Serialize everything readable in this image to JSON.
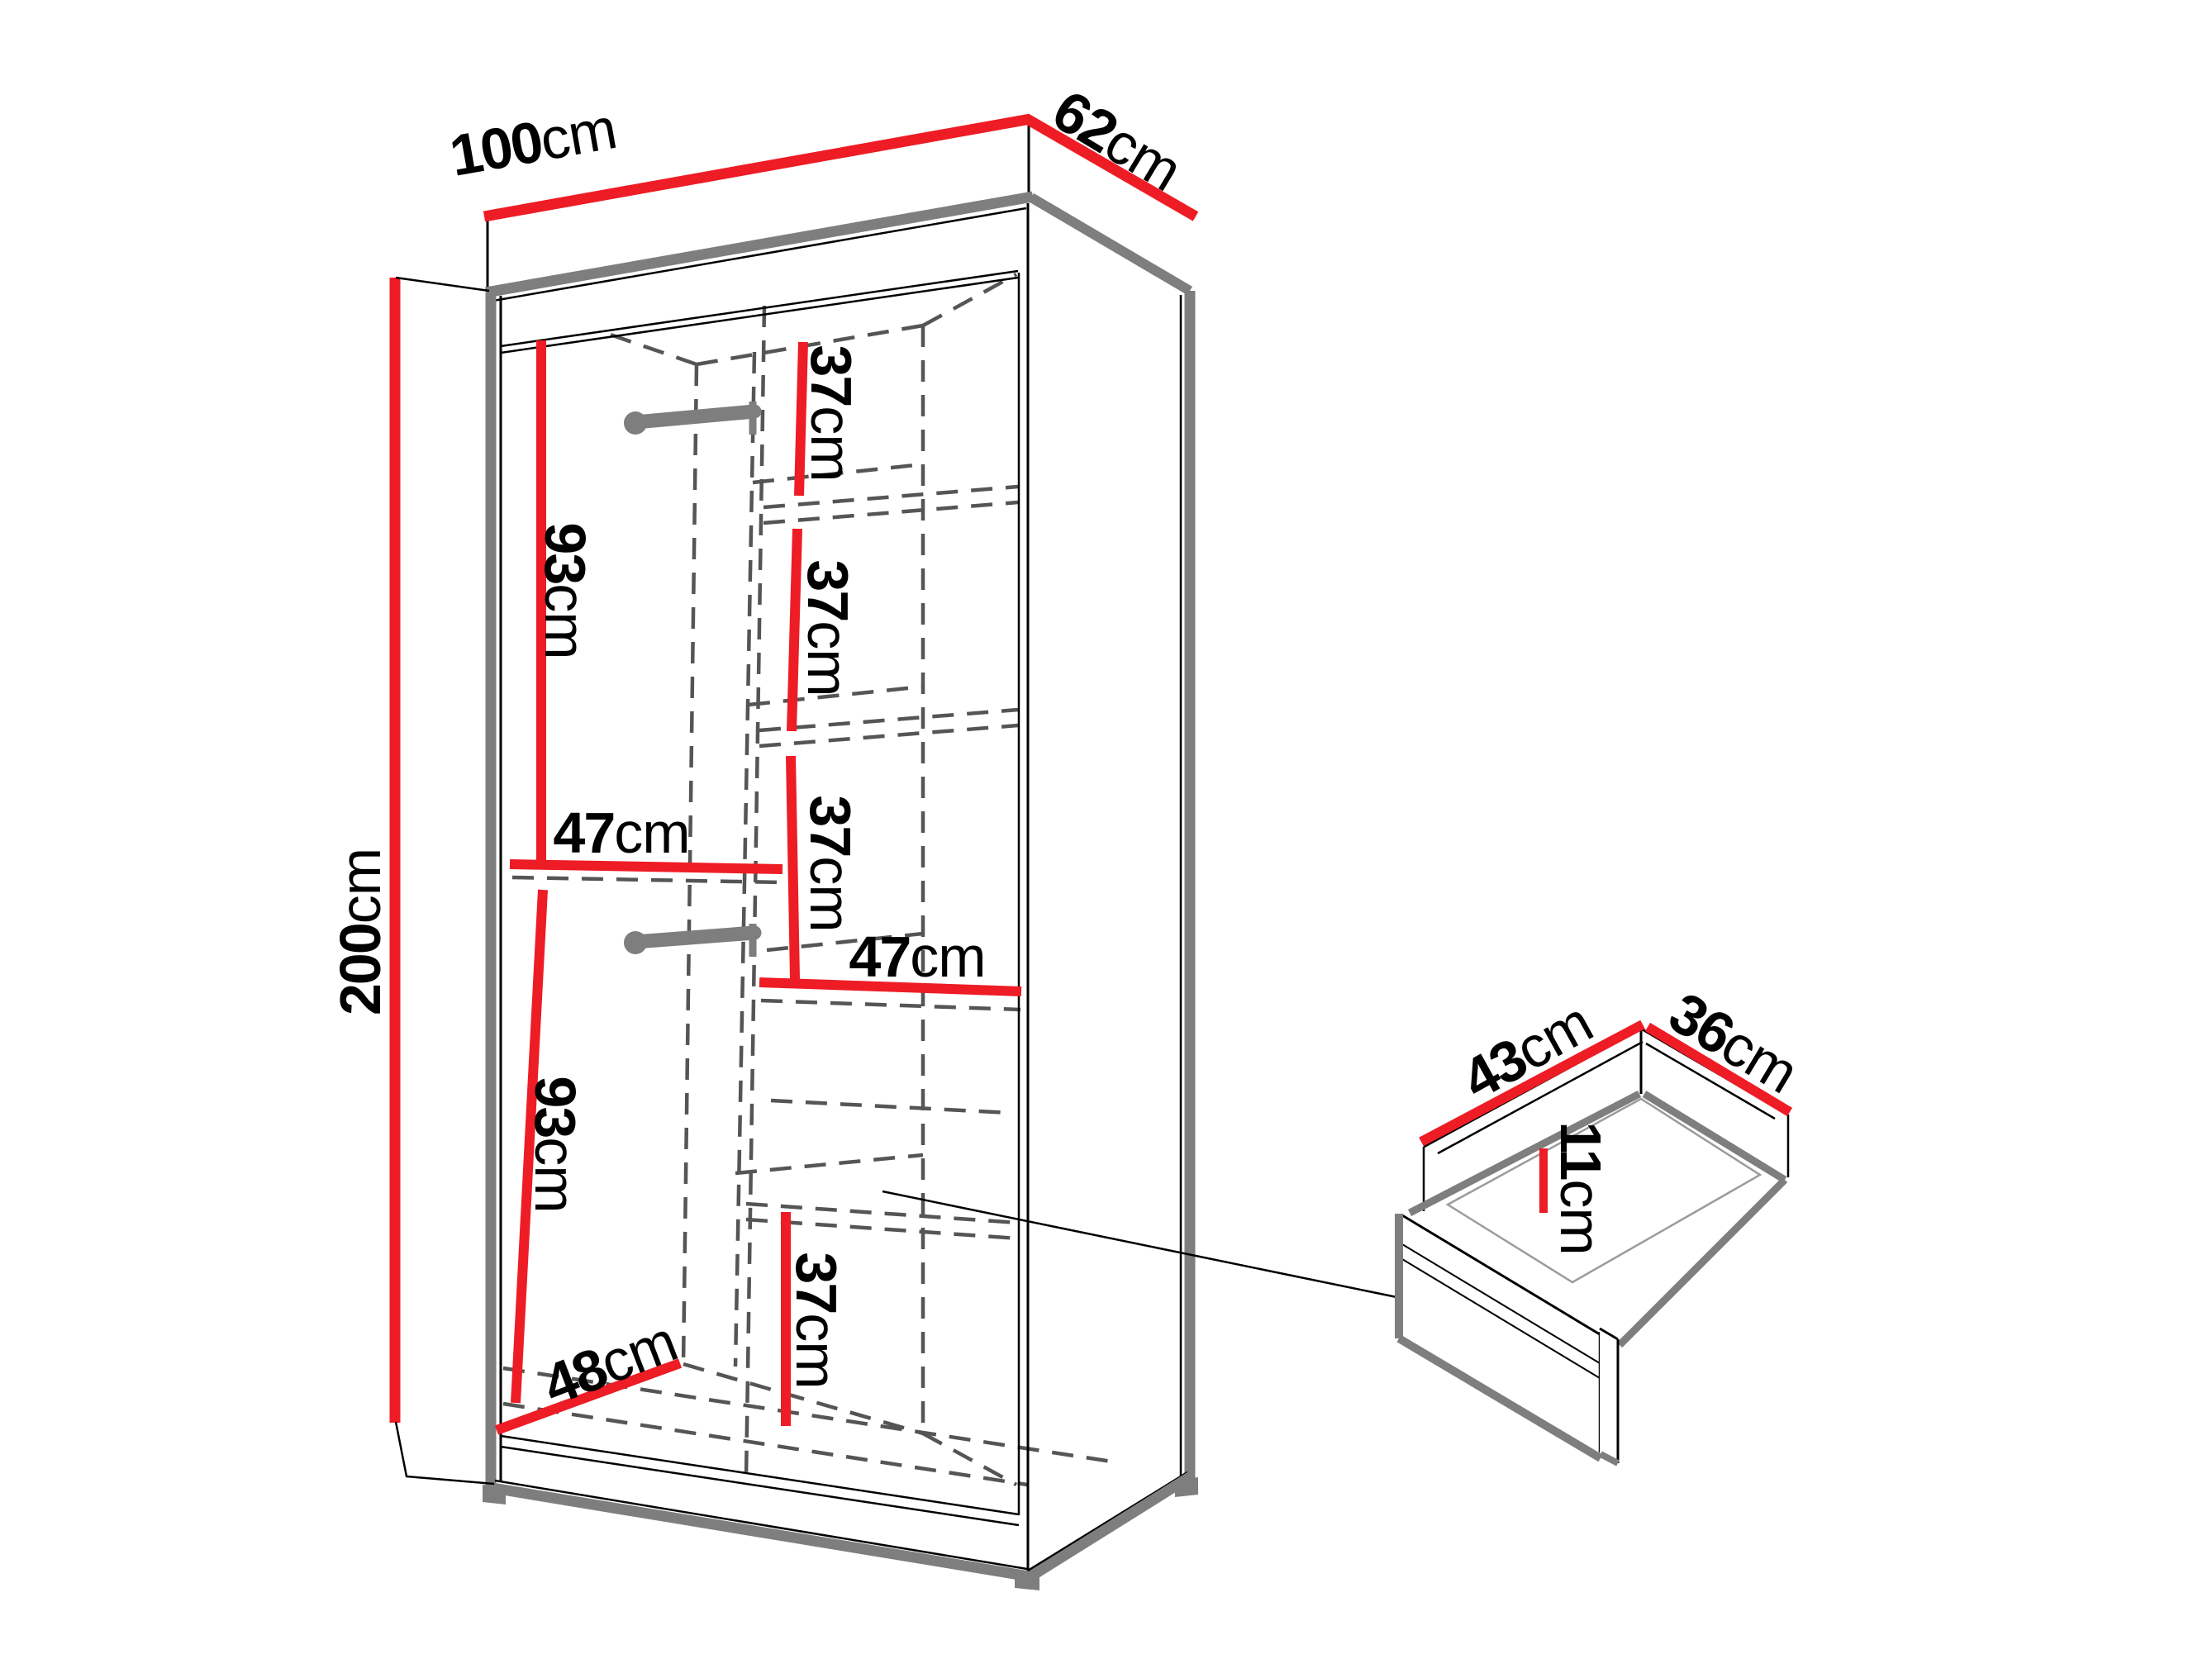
{
  "colors": {
    "background": "#ffffff",
    "dimension_red": "#ee1c25",
    "outline_gray": "#7e7e7e",
    "dashed_gray": "#555555",
    "text_black": "#000000"
  },
  "wardrobe": {
    "dims": {
      "width": {
        "value": "100",
        "unit": "cm"
      },
      "depth": {
        "value": "62",
        "unit": "cm"
      },
      "height": {
        "value": "200",
        "unit": "cm"
      },
      "upper_hanging": {
        "value": "93",
        "unit": "cm"
      },
      "lower_hanging": {
        "value": "93",
        "unit": "cm"
      },
      "left_shelf_width": {
        "value": "47",
        "unit": "cm"
      },
      "right_shelf_width": {
        "value": "47",
        "unit": "cm"
      },
      "shelf_gap_top": {
        "value": "37",
        "unit": "cm"
      },
      "shelf_gap_mid": {
        "value": "37",
        "unit": "cm"
      },
      "shelf_gap_low": {
        "value": "37",
        "unit": "cm"
      },
      "bottom_compartment": {
        "value": "37",
        "unit": "cm"
      },
      "interior_depth": {
        "value": "48",
        "unit": "cm"
      }
    }
  },
  "drawer": {
    "dims": {
      "depth": {
        "value": "43",
        "unit": "cm"
      },
      "width": {
        "value": "36",
        "unit": "cm"
      },
      "height": {
        "value": "11",
        "unit": "cm"
      }
    }
  }
}
